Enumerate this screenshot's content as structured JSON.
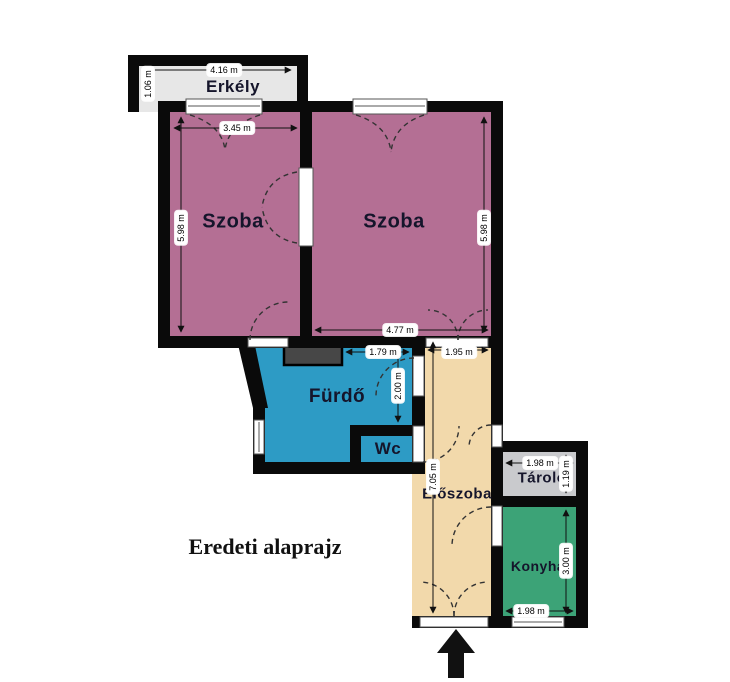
{
  "caption": "Eredeti alaprajz",
  "colors": {
    "room": "#b46f94",
    "bathroom": "#2d9bc5",
    "hallway": "#f2d9ab",
    "storage": "#c9cacd",
    "kitchen": "#3ca377",
    "balcony": "#e7e7e7",
    "wall": "#0a0a0a",
    "niche": "#474747",
    "dimension_line": "#111111",
    "door_swing": "#333333"
  },
  "rooms": {
    "erkely": {
      "label": "Erkély",
      "width": "4.16 m",
      "height": "1.06 m"
    },
    "szoba_left": {
      "label": "Szoba",
      "width": "3.45 m",
      "height": "5.98 m"
    },
    "szoba_right": {
      "label": "Szoba",
      "width": "4.77 m",
      "height": "5.98 m"
    },
    "furdo": {
      "label": "Fürdő",
      "width": "1.79 m",
      "height": "2.00 m"
    },
    "wc": {
      "label": "Wc"
    },
    "eloszoba": {
      "label": "Előszoba",
      "width": "1.95 m",
      "height": "7.05 m"
    },
    "tarolo": {
      "label": "Tároló",
      "width": "1.98 m",
      "height": "1.19 m"
    },
    "konyha": {
      "label": "Konyha",
      "width": "1.98 m",
      "height": "3.00 m"
    }
  }
}
